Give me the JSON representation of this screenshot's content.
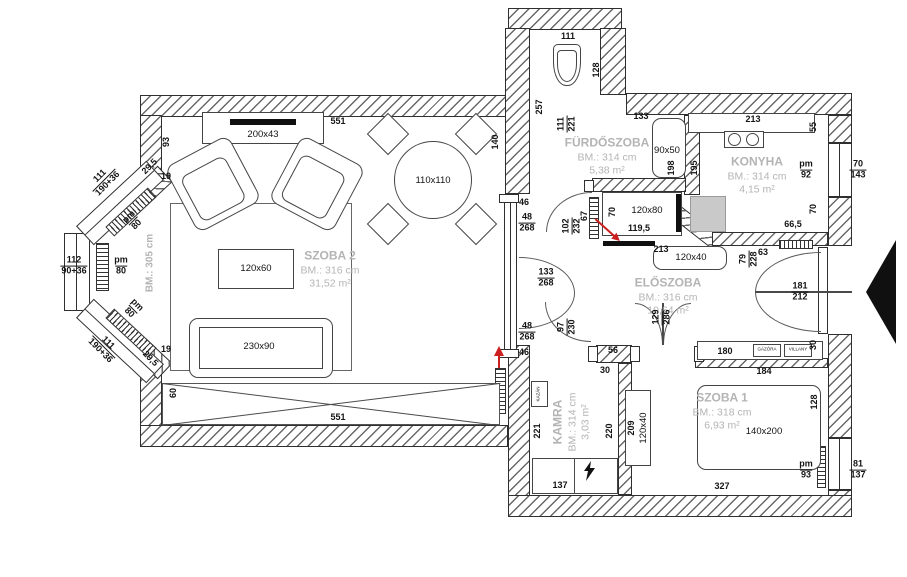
{
  "colors": {
    "background": "#ffffff",
    "wall_line": "#2f2f2f",
    "room_label_gray": "#b4b4b4",
    "red_accent": "#cc1f1f",
    "appliance_gray": "#c9c9c9",
    "furniture_line": "#454545"
  },
  "rooms": [
    {
      "name": "SZOBA 2",
      "bm": "BM.: 316 cm",
      "area": "31,52 m²"
    },
    {
      "name": "FÜRDŐSZOBA",
      "bm": "BM.: 314 cm",
      "area": "5,38 m²"
    },
    {
      "name": "KONYHA",
      "bm": "BM.: 314 cm",
      "area": "4,15 m²"
    },
    {
      "name": "ELŐSZOBA",
      "bm": "BM.: 316 cm",
      "area": "10,64 m²"
    },
    {
      "name": "KAMRA",
      "bm": "BM.: 314 cm",
      "area": "3,03 m²"
    },
    {
      "name": "SZOBA 1",
      "bm": "BM.: 318 cm",
      "area": "6,93 m²"
    }
  ],
  "labels": [
    {
      "id": "dim-551-top",
      "t": "551",
      "x": 338,
      "y": 122
    },
    {
      "id": "dim-93",
      "t": "93",
      "x": 167,
      "y": 142,
      "r": -90
    },
    {
      "id": "dim-29-5-top",
      "t": "29,5",
      "x": 150,
      "y": 167,
      "r": -45
    },
    {
      "id": "dim-19-top",
      "t": "19",
      "x": 166,
      "y": 177
    },
    {
      "id": "lbl-shelf",
      "t": "200x43",
      "x": 263,
      "y": 135,
      "c": "f"
    },
    {
      "id": "lbl-table-round",
      "t": "110x110",
      "x": 433,
      "y": 181,
      "c": "f"
    },
    {
      "id": "dim-bay-upper",
      "t": "111",
      "t2": "190+36",
      "x": 104,
      "y": 180,
      "r": -45
    },
    {
      "id": "dim-bay-upper-pm",
      "t": "pm",
      "t2": "80",
      "x": 133,
      "y": 221,
      "r": -45
    },
    {
      "id": "dim-bay-flat",
      "t": "112",
      "t2": "90+36",
      "x": 74,
      "y": 266
    },
    {
      "id": "dim-bay-flat-pm",
      "t": "pm",
      "t2": "80",
      "x": 121,
      "y": 266
    },
    {
      "id": "bm-bay",
      "t": "BM.: 305 cm",
      "x": 150,
      "y": 263,
      "r": -90,
      "c": "g"
    },
    {
      "id": "dim-bay-lower-pm",
      "t": "pm",
      "t2": "80",
      "x": 133,
      "y": 309,
      "r": 45
    },
    {
      "id": "dim-bay-lower",
      "t": "111",
      "t2": "190+36",
      "x": 104,
      "y": 347,
      "r": 45
    },
    {
      "id": "dim-29-5-bot",
      "t": "29,5",
      "x": 150,
      "y": 359,
      "r": 45
    },
    {
      "id": "dim-19-bot",
      "t": "19",
      "x": 166,
      "y": 350
    },
    {
      "id": "lbl-coffee-table",
      "t": "120x60",
      "x": 256,
      "y": 269,
      "c": "f"
    },
    {
      "id": "lbl-sofa",
      "t": "230x90",
      "x": 259,
      "y": 347,
      "c": "f"
    },
    {
      "id": "dim-60",
      "t": "60",
      "x": 174,
      "y": 393,
      "r": -90
    },
    {
      "id": "dim-551-bottom",
      "t": "551",
      "x": 338,
      "y": 418
    },
    {
      "id": "dim-140",
      "t": "140",
      "x": 496,
      "y": 142,
      "r": -90
    },
    {
      "id": "dim-46-top",
      "t": "46",
      "x": 524,
      "y": 203
    },
    {
      "id": "dim-48-268-top",
      "t": "48",
      "t2": "268",
      "x": 527,
      "y": 223
    },
    {
      "id": "dim-133-268",
      "t": "133",
      "t2": "268",
      "x": 546,
      "y": 278
    },
    {
      "id": "dim-48-268-bot",
      "t": "48",
      "t2": "268",
      "x": 527,
      "y": 332
    },
    {
      "id": "dim-46-bot",
      "t": "46",
      "x": 524,
      "y": 353
    },
    {
      "id": "dim-111-wc",
      "t": "111",
      "x": 568,
      "y": 37
    },
    {
      "id": "dim-128-wc",
      "t": "128",
      "x": 597,
      "y": 70,
      "r": -90
    },
    {
      "id": "dim-257",
      "t": "257",
      "x": 540,
      "y": 107,
      "r": -90
    },
    {
      "id": "dim-111-221",
      "t": "111",
      "t2": "221",
      "x": 567,
      "y": 124,
      "r": -90
    },
    {
      "id": "dim-133-tub",
      "t": "133",
      "x": 641,
      "y": 117
    },
    {
      "id": "lbl-tub",
      "t": "90x50",
      "x": 667,
      "y": 151,
      "c": "f"
    },
    {
      "id": "dim-198",
      "t": "198",
      "x": 672,
      "y": 168,
      "r": -90
    },
    {
      "id": "dim-195",
      "t": "195",
      "x": 695,
      "y": 168,
      "r": -90
    },
    {
      "id": "dim-213-kitchen",
      "t": "213",
      "x": 753,
      "y": 120
    },
    {
      "id": "dim-55",
      "t": "55",
      "x": 814,
      "y": 127,
      "r": -90
    },
    {
      "id": "dim-pm92",
      "t": "pm",
      "t2": "92",
      "x": 806,
      "y": 170
    },
    {
      "id": "dim-70-143",
      "t": "70",
      "t2": "143",
      "x": 858,
      "y": 170
    },
    {
      "id": "dim-70-kitchen",
      "t": "70",
      "x": 814,
      "y": 209,
      "r": -90
    },
    {
      "id": "dim-66-5",
      "t": "66,5",
      "x": 793,
      "y": 225
    },
    {
      "id": "dim-102-232",
      "t": "102",
      "t2": "232",
      "x": 572,
      "y": 226,
      "r": -90
    },
    {
      "id": "dim-67",
      "t": "67",
      "x": 585,
      "y": 216,
      "r": -90
    },
    {
      "id": "dim-70-hall",
      "t": "70",
      "x": 613,
      "y": 212,
      "r": -90
    },
    {
      "id": "lbl-hall-cabinet",
      "t": "120x80",
      "x": 647,
      "y": 211,
      "c": "f"
    },
    {
      "id": "dim-119-5",
      "t": "119,5",
      "x": 639,
      "y": 229
    },
    {
      "id": "dim-213-hall",
      "t": "213",
      "x": 661,
      "y": 250
    },
    {
      "id": "lbl-hall-bench",
      "t": "120x40",
      "x": 691,
      "y": 258,
      "c": "f"
    },
    {
      "id": "dim-63",
      "t": "63",
      "x": 763,
      "y": 253
    },
    {
      "id": "dim-79-228",
      "t": "79",
      "t2": "228",
      "x": 749,
      "y": 259,
      "r": -90
    },
    {
      "id": "dim-181-212",
      "t": "181",
      "t2": "212",
      "x": 800,
      "y": 292
    },
    {
      "id": "dim-30-entry",
      "t": "30",
      "x": 814,
      "y": 345,
      "r": -90
    },
    {
      "id": "dim-180",
      "t": "180",
      "x": 725,
      "y": 352
    },
    {
      "id": "lbl-gazora",
      "t": "GÁZÓRA",
      "x": 767,
      "y": 350,
      "c": "tiny"
    },
    {
      "id": "lbl-villany",
      "t": "VILLANY",
      "x": 798,
      "y": 350,
      "c": "tiny"
    },
    {
      "id": "dim-184",
      "t": "184",
      "x": 764,
      "y": 372
    },
    {
      "id": "dim-97-230",
      "t": "97",
      "t2": "230",
      "x": 567,
      "y": 327,
      "r": -90
    },
    {
      "id": "dim-129-286",
      "t": "129",
      "t2": "286",
      "x": 662,
      "y": 317,
      "r": -90
    },
    {
      "id": "dim-56",
      "t": "56",
      "x": 613,
      "y": 351
    },
    {
      "id": "dim-30-kamra",
      "t": "30",
      "x": 605,
      "y": 371
    },
    {
      "id": "lbl-kazan",
      "t": "KAZÁN",
      "x": 539,
      "y": 394,
      "r": -90,
      "c": "tiny"
    },
    {
      "id": "dim-221",
      "t": "221",
      "x": 538,
      "y": 431,
      "r": -90
    },
    {
      "id": "dim-220",
      "t": "220",
      "x": 610,
      "y": 431,
      "r": -90
    },
    {
      "id": "dim-137",
      "t": "137",
      "x": 560,
      "y": 486
    },
    {
      "id": "dim-209",
      "t": "209",
      "x": 632,
      "y": 428,
      "r": -90
    },
    {
      "id": "lbl-wardrobe",
      "t": "120x40",
      "x": 644,
      "y": 428,
      "r": -90,
      "c": "f"
    },
    {
      "id": "lbl-bed",
      "t": "140x200",
      "x": 764,
      "y": 432,
      "c": "f"
    },
    {
      "id": "dim-128-szoba1",
      "t": "128",
      "x": 815,
      "y": 402,
      "r": -90
    },
    {
      "id": "dim-pm93",
      "t": "pm",
      "t2": "93",
      "x": 806,
      "y": 470
    },
    {
      "id": "dim-81-137",
      "t": "81",
      "t2": "137",
      "x": 858,
      "y": 470
    },
    {
      "id": "dim-327",
      "t": "327",
      "x": 722,
      "y": 487
    }
  ]
}
